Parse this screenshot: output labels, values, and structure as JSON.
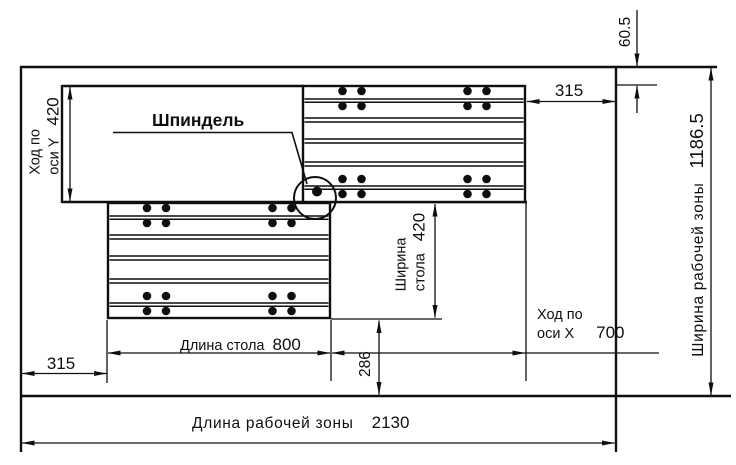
{
  "colors": {
    "ink": "#0f0f0f",
    "background": "#ffffff"
  },
  "drawing": {
    "spindle_label": "Шпиндель",
    "y_axis_travel": {
      "label_line1": "Ход по",
      "label_line2": "оси Y",
      "value": "420"
    },
    "spindle_top_offset": {
      "value": "60.5"
    },
    "right_edge_gap": {
      "value": "315"
    },
    "working_zone_width": {
      "label": "Ширина рабочей зоны",
      "value": "1186.5"
    },
    "table_width": {
      "label_line1": "Ширина",
      "label_line2": "стола",
      "value": "420"
    },
    "x_axis_travel": {
      "label_line1": "Ход по",
      "label_line2": "оси X",
      "value": "700"
    },
    "table_length": {
      "label": "Длина стола",
      "value": "800"
    },
    "table_bottom_offset": {
      "value": "286"
    },
    "left_edge_gap": {
      "value": "315"
    },
    "working_zone_length": {
      "label": "Длина рабочей зоны",
      "value": "2130"
    }
  }
}
